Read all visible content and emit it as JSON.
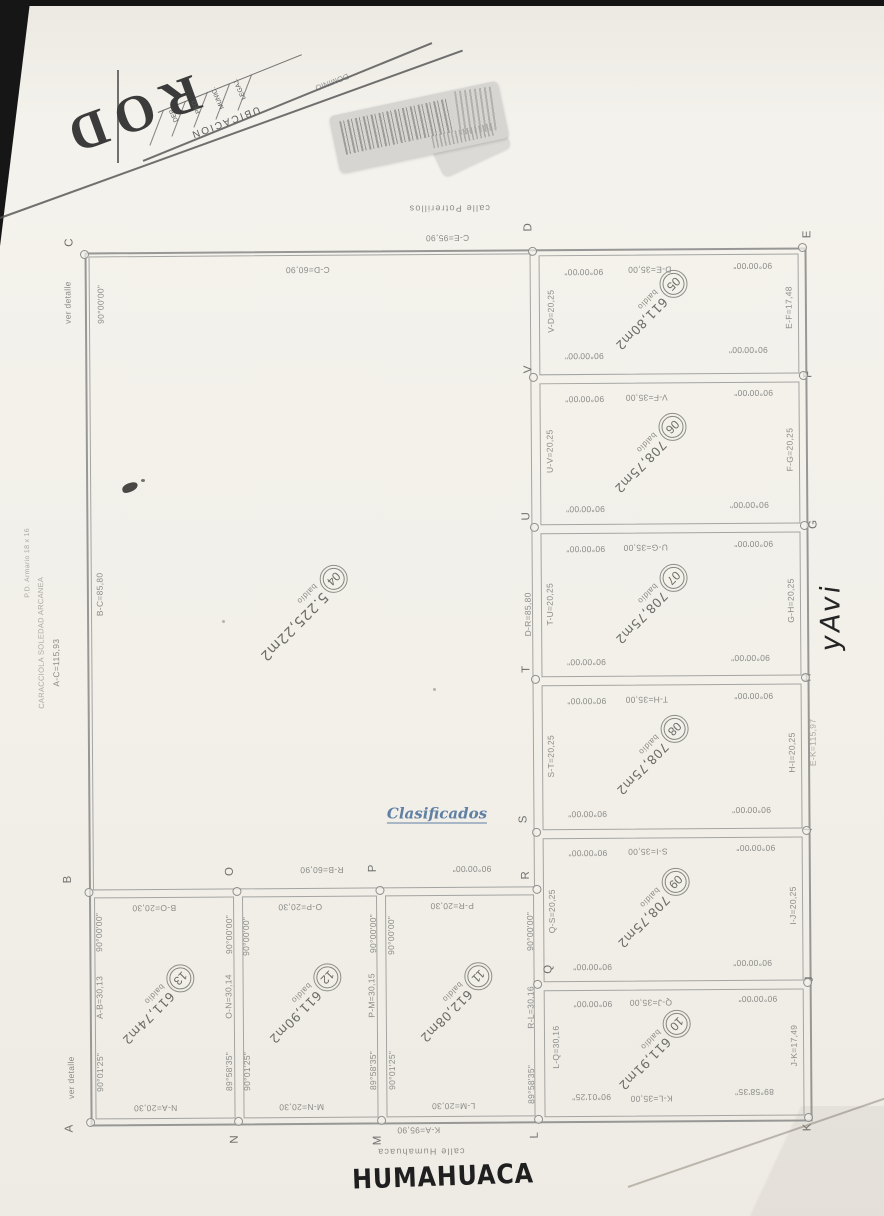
{
  "watermark": "Clasificados",
  "handwriting": {
    "side": "yAvi",
    "bottom": "HUMAHUACA"
  },
  "title_block": {
    "big_text": "ROD",
    "header": "UBICACION",
    "columns": [
      "DEP.",
      "PED.",
      "MUNIC.",
      "LEGAJ."
    ],
    "partial_word": "DOMINIO"
  },
  "lots": {
    "04": {
      "num": "04",
      "area": "5.225,22m2",
      "use": "baldío"
    },
    "05": {
      "num": "05",
      "area": "611,80m2",
      "use": "baldío"
    },
    "06": {
      "num": "06",
      "area": "708,75m2",
      "use": "baldío"
    },
    "07": {
      "num": "07",
      "area": "708,75m2",
      "use": "baldío"
    },
    "08": {
      "num": "08",
      "area": "708,75m2",
      "use": "baldío"
    },
    "09": {
      "num": "09",
      "area": "708,75m2",
      "use": "baldío"
    },
    "10": {
      "num": "10",
      "area": "611,91m2",
      "use": "baldío"
    },
    "11": {
      "num": "11",
      "area": "612,08m2",
      "use": "baldío"
    },
    "12": {
      "num": "12",
      "area": "611,90m2",
      "use": "baldío"
    },
    "13": {
      "num": "13",
      "area": "611,74m2",
      "use": "baldío"
    }
  },
  "plan": {
    "labels": [
      {
        "t": "calle Potrerillos",
        "x": 452,
        "y": 208,
        "r": 180,
        "c": "street"
      },
      {
        "t": "C-E=95,90",
        "x": 450,
        "y": 238,
        "r": 180
      },
      {
        "t": "C-D=60,90",
        "x": 310,
        "y": 269,
        "r": 180
      },
      {
        "t": "D-E=35,00",
        "x": 652,
        "y": 271,
        "r": 180
      },
      {
        "t": "90°00'00\"",
        "x": 586,
        "y": 273,
        "r": 180
      },
      {
        "t": "90°00'00\"",
        "x": 755,
        "y": 268,
        "r": 180
      },
      {
        "t": "90°00'00\"",
        "x": 586,
        "y": 357,
        "r": 180
      },
      {
        "t": "90°00'00\"",
        "x": 750,
        "y": 352,
        "r": 180
      },
      {
        "t": "V-F=35,00",
        "x": 648,
        "y": 399,
        "r": 180
      },
      {
        "t": "90°00'00\"",
        "x": 586,
        "y": 400,
        "r": 180
      },
      {
        "t": "90°00'00\"",
        "x": 755,
        "y": 395,
        "r": 180
      },
      {
        "t": "90°00'00\"",
        "x": 586,
        "y": 510,
        "r": 180
      },
      {
        "t": "90°00'00\"",
        "x": 750,
        "y": 507,
        "r": 180
      },
      {
        "t": "U-G=35,00",
        "x": 646,
        "y": 549,
        "r": 180
      },
      {
        "t": "90°00'00\"",
        "x": 586,
        "y": 550,
        "r": 180
      },
      {
        "t": "90°00'00\"",
        "x": 754,
        "y": 546,
        "r": 180
      },
      {
        "t": "90°00'00\"",
        "x": 586,
        "y": 663,
        "r": 180
      },
      {
        "t": "90°00'00\"",
        "x": 750,
        "y": 660,
        "r": 180
      },
      {
        "t": "T-H=35,00",
        "x": 646,
        "y": 701,
        "r": 180
      },
      {
        "t": "90°00'00\"",
        "x": 586,
        "y": 702,
        "r": 180
      },
      {
        "t": "90°00'00\"",
        "x": 753,
        "y": 698,
        "r": 180
      },
      {
        "t": "90°00'00\"",
        "x": 586,
        "y": 815,
        "r": 180
      },
      {
        "t": "90°00'00\"",
        "x": 750,
        "y": 812,
        "r": 180
      },
      {
        "t": "S-I=35,00",
        "x": 646,
        "y": 853,
        "r": 180
      },
      {
        "t": "90°00'00\"",
        "x": 586,
        "y": 854,
        "r": 180
      },
      {
        "t": "90°00'00\"",
        "x": 754,
        "y": 850,
        "r": 180
      },
      {
        "t": "90°00'00\"",
        "x": 590,
        "y": 968,
        "r": 180
      },
      {
        "t": "90°00'00\"",
        "x": 750,
        "y": 965,
        "r": 180
      },
      {
        "t": "Q-J=35,00",
        "x": 648,
        "y": 1004,
        "r": 180
      },
      {
        "t": "90°00'00\"",
        "x": 590,
        "y": 1005,
        "r": 180
      },
      {
        "t": "90°00'00\"",
        "x": 755,
        "y": 1001,
        "r": 180
      },
      {
        "t": "90°01'25\"",
        "x": 588,
        "y": 1098,
        "r": 180
      },
      {
        "t": "89°58'35\"",
        "x": 751,
        "y": 1094,
        "r": 180
      },
      {
        "t": "K-L=35,00",
        "x": 648,
        "y": 1100,
        "r": 180
      },
      {
        "t": "R-B=60,90",
        "x": 320,
        "y": 869,
        "r": 180
      },
      {
        "t": "90°00'00\"",
        "x": 470,
        "y": 869,
        "r": 180
      },
      {
        "t": "B-O=20,30",
        "x": 152,
        "y": 906,
        "r": 180
      },
      {
        "t": "O-P=20,30",
        "x": 298,
        "y": 906,
        "r": 180
      },
      {
        "t": "P-R=20,30",
        "x": 450,
        "y": 906,
        "r": 180
      },
      {
        "t": "N-A=20,30",
        "x": 152,
        "y": 1106,
        "r": 180
      },
      {
        "t": "M-N=20,30",
        "x": 298,
        "y": 1106,
        "r": 180
      },
      {
        "t": "L-M=20,30",
        "x": 450,
        "y": 1106,
        "r": 180
      },
      {
        "t": "K-A=95,90",
        "x": 415,
        "y": 1130,
        "r": 180
      },
      {
        "t": "calle Humahuaca",
        "x": 417,
        "y": 1151,
        "r": 180,
        "c": "street"
      },
      {
        "t": "ver detalle",
        "x": 70,
        "y": 300,
        "r": -90
      },
      {
        "t": "90°00'00\"",
        "x": 103,
        "y": 302,
        "r": -90
      },
      {
        "t": "B-C=85,80",
        "x": 100,
        "y": 592,
        "r": -90
      },
      {
        "t": "A-C=115,93",
        "x": 56,
        "y": 660,
        "r": -90
      },
      {
        "t": "CARACCIOLA SOLEDAD ARCANEA",
        "x": 41,
        "y": 640,
        "r": -90,
        "c": "faint",
        "s": 7.5
      },
      {
        "t": "P.D. Armario 18 x 16",
        "x": 28,
        "y": 560,
        "r": -90,
        "c": "faint",
        "s": 7
      },
      {
        "t": "V-D=20,25",
        "x": 553,
        "y": 312,
        "r": -90
      },
      {
        "t": "E-F=17,48",
        "x": 791,
        "y": 310,
        "r": -90
      },
      {
        "t": "U-V=20,25",
        "x": 551,
        "y": 452,
        "r": -90
      },
      {
        "t": "F-G=20,25",
        "x": 791,
        "y": 452,
        "r": -90
      },
      {
        "t": "T-U=20,25",
        "x": 550,
        "y": 605,
        "r": -90
      },
      {
        "t": "G-H=20,25",
        "x": 791,
        "y": 603,
        "r": -90
      },
      {
        "t": "D-R=85,80",
        "x": 528,
        "y": 615,
        "r": -90
      },
      {
        "t": "S-T=20,25",
        "x": 550,
        "y": 757,
        "r": -90
      },
      {
        "t": "H-I=20,25",
        "x": 791,
        "y": 755,
        "r": -90
      },
      {
        "t": "E-K=115,97",
        "x": 812,
        "y": 745,
        "r": -90,
        "c": "faint"
      },
      {
        "t": "Q-S=20,25",
        "x": 550,
        "y": 912,
        "r": -90
      },
      {
        "t": "I-J=20,25",
        "x": 791,
        "y": 908,
        "r": -90
      },
      {
        "t": "L-Q=30,16",
        "x": 553,
        "y": 1048,
        "r": -90
      },
      {
        "t": "J-K=17,49",
        "x": 791,
        "y": 1048,
        "r": -90
      },
      {
        "t": "R-L=30,16",
        "x": 528,
        "y": 1008,
        "r": -90
      },
      {
        "t": "89°58'35\"",
        "x": 528,
        "y": 1085,
        "r": -90
      },
      {
        "t": "90°00'00\"",
        "x": 528,
        "y": 932,
        "r": -90
      },
      {
        "t": "A-B=30,13",
        "x": 97,
        "y": 995,
        "r": -90
      },
      {
        "t": "O-N=30,14",
        "x": 226,
        "y": 995,
        "r": -90
      },
      {
        "t": "P-M=30,15",
        "x": 369,
        "y": 995,
        "r": -90
      },
      {
        "t": "90°00'00\"",
        "x": 97,
        "y": 930,
        "r": -90
      },
      {
        "t": "90°00'00\"",
        "x": 227,
        "y": 933,
        "r": -90
      },
      {
        "t": "90°01'25\"",
        "x": 97,
        "y": 1070,
        "r": -90
      },
      {
        "t": "89°58'35\"",
        "x": 226,
        "y": 1070,
        "r": -90
      },
      {
        "t": "90°00'00\"",
        "x": 244,
        "y": 935,
        "r": -90
      },
      {
        "t": "90°00'00\"",
        "x": 371,
        "y": 933,
        "r": -90
      },
      {
        "t": "90°01'25\"",
        "x": 244,
        "y": 1070,
        "r": -90
      },
      {
        "t": "89°58'35\"",
        "x": 370,
        "y": 1070,
        "r": -90
      },
      {
        "t": "90°00'00\"",
        "x": 389,
        "y": 935,
        "r": -90
      },
      {
        "t": "90°01'25\"",
        "x": 389,
        "y": 1070,
        "r": -90
      },
      {
        "t": "ver detalle",
        "x": 68,
        "y": 1075,
        "r": -90
      }
    ],
    "corner_letters": [
      {
        "t": "A",
        "x": 66,
        "y": 1126
      },
      {
        "t": "B",
        "x": 66,
        "y": 877
      },
      {
        "t": "C",
        "x": 72,
        "y": 240
      },
      {
        "t": "D",
        "x": 531,
        "y": 228
      },
      {
        "t": "E",
        "x": 810,
        "y": 237
      },
      {
        "t": "F",
        "x": 810,
        "y": 377
      },
      {
        "t": "G",
        "x": 814,
        "y": 527
      },
      {
        "t": "H",
        "x": 807,
        "y": 680
      },
      {
        "t": "I",
        "x": 807,
        "y": 832
      },
      {
        "t": "J",
        "x": 807,
        "y": 982
      },
      {
        "t": "K",
        "x": 804,
        "y": 1130
      },
      {
        "t": "L",
        "x": 531,
        "y": 1136
      },
      {
        "t": "M",
        "x": 374,
        "y": 1140
      },
      {
        "t": "N",
        "x": 231,
        "y": 1138
      },
      {
        "t": "O",
        "x": 228,
        "y": 870
      },
      {
        "t": "P",
        "x": 371,
        "y": 868
      },
      {
        "t": "Q",
        "x": 546,
        "y": 970
      },
      {
        "t": "R",
        "x": 524,
        "y": 876
      },
      {
        "t": "S",
        "x": 522,
        "y": 820
      },
      {
        "t": "T",
        "x": 526,
        "y": 670
      },
      {
        "t": "U",
        "x": 527,
        "y": 517
      },
      {
        "t": "V",
        "x": 530,
        "y": 370
      }
    ],
    "markers": [
      [
        87,
        252
      ],
      [
        535,
        252
      ],
      [
        805,
        250
      ],
      [
        87,
        890
      ],
      [
        235,
        890
      ],
      [
        378,
        890
      ],
      [
        535,
        890
      ],
      [
        87,
        1120
      ],
      [
        235,
        1120
      ],
      [
        378,
        1120
      ],
      [
        535,
        1120
      ],
      [
        805,
        1120
      ],
      [
        535,
        378
      ],
      [
        535,
        528
      ],
      [
        535,
        680
      ],
      [
        535,
        833
      ],
      [
        535,
        985
      ],
      [
        805,
        378
      ],
      [
        805,
        528
      ],
      [
        805,
        680
      ],
      [
        805,
        833
      ],
      [
        805,
        985
      ]
    ]
  }
}
